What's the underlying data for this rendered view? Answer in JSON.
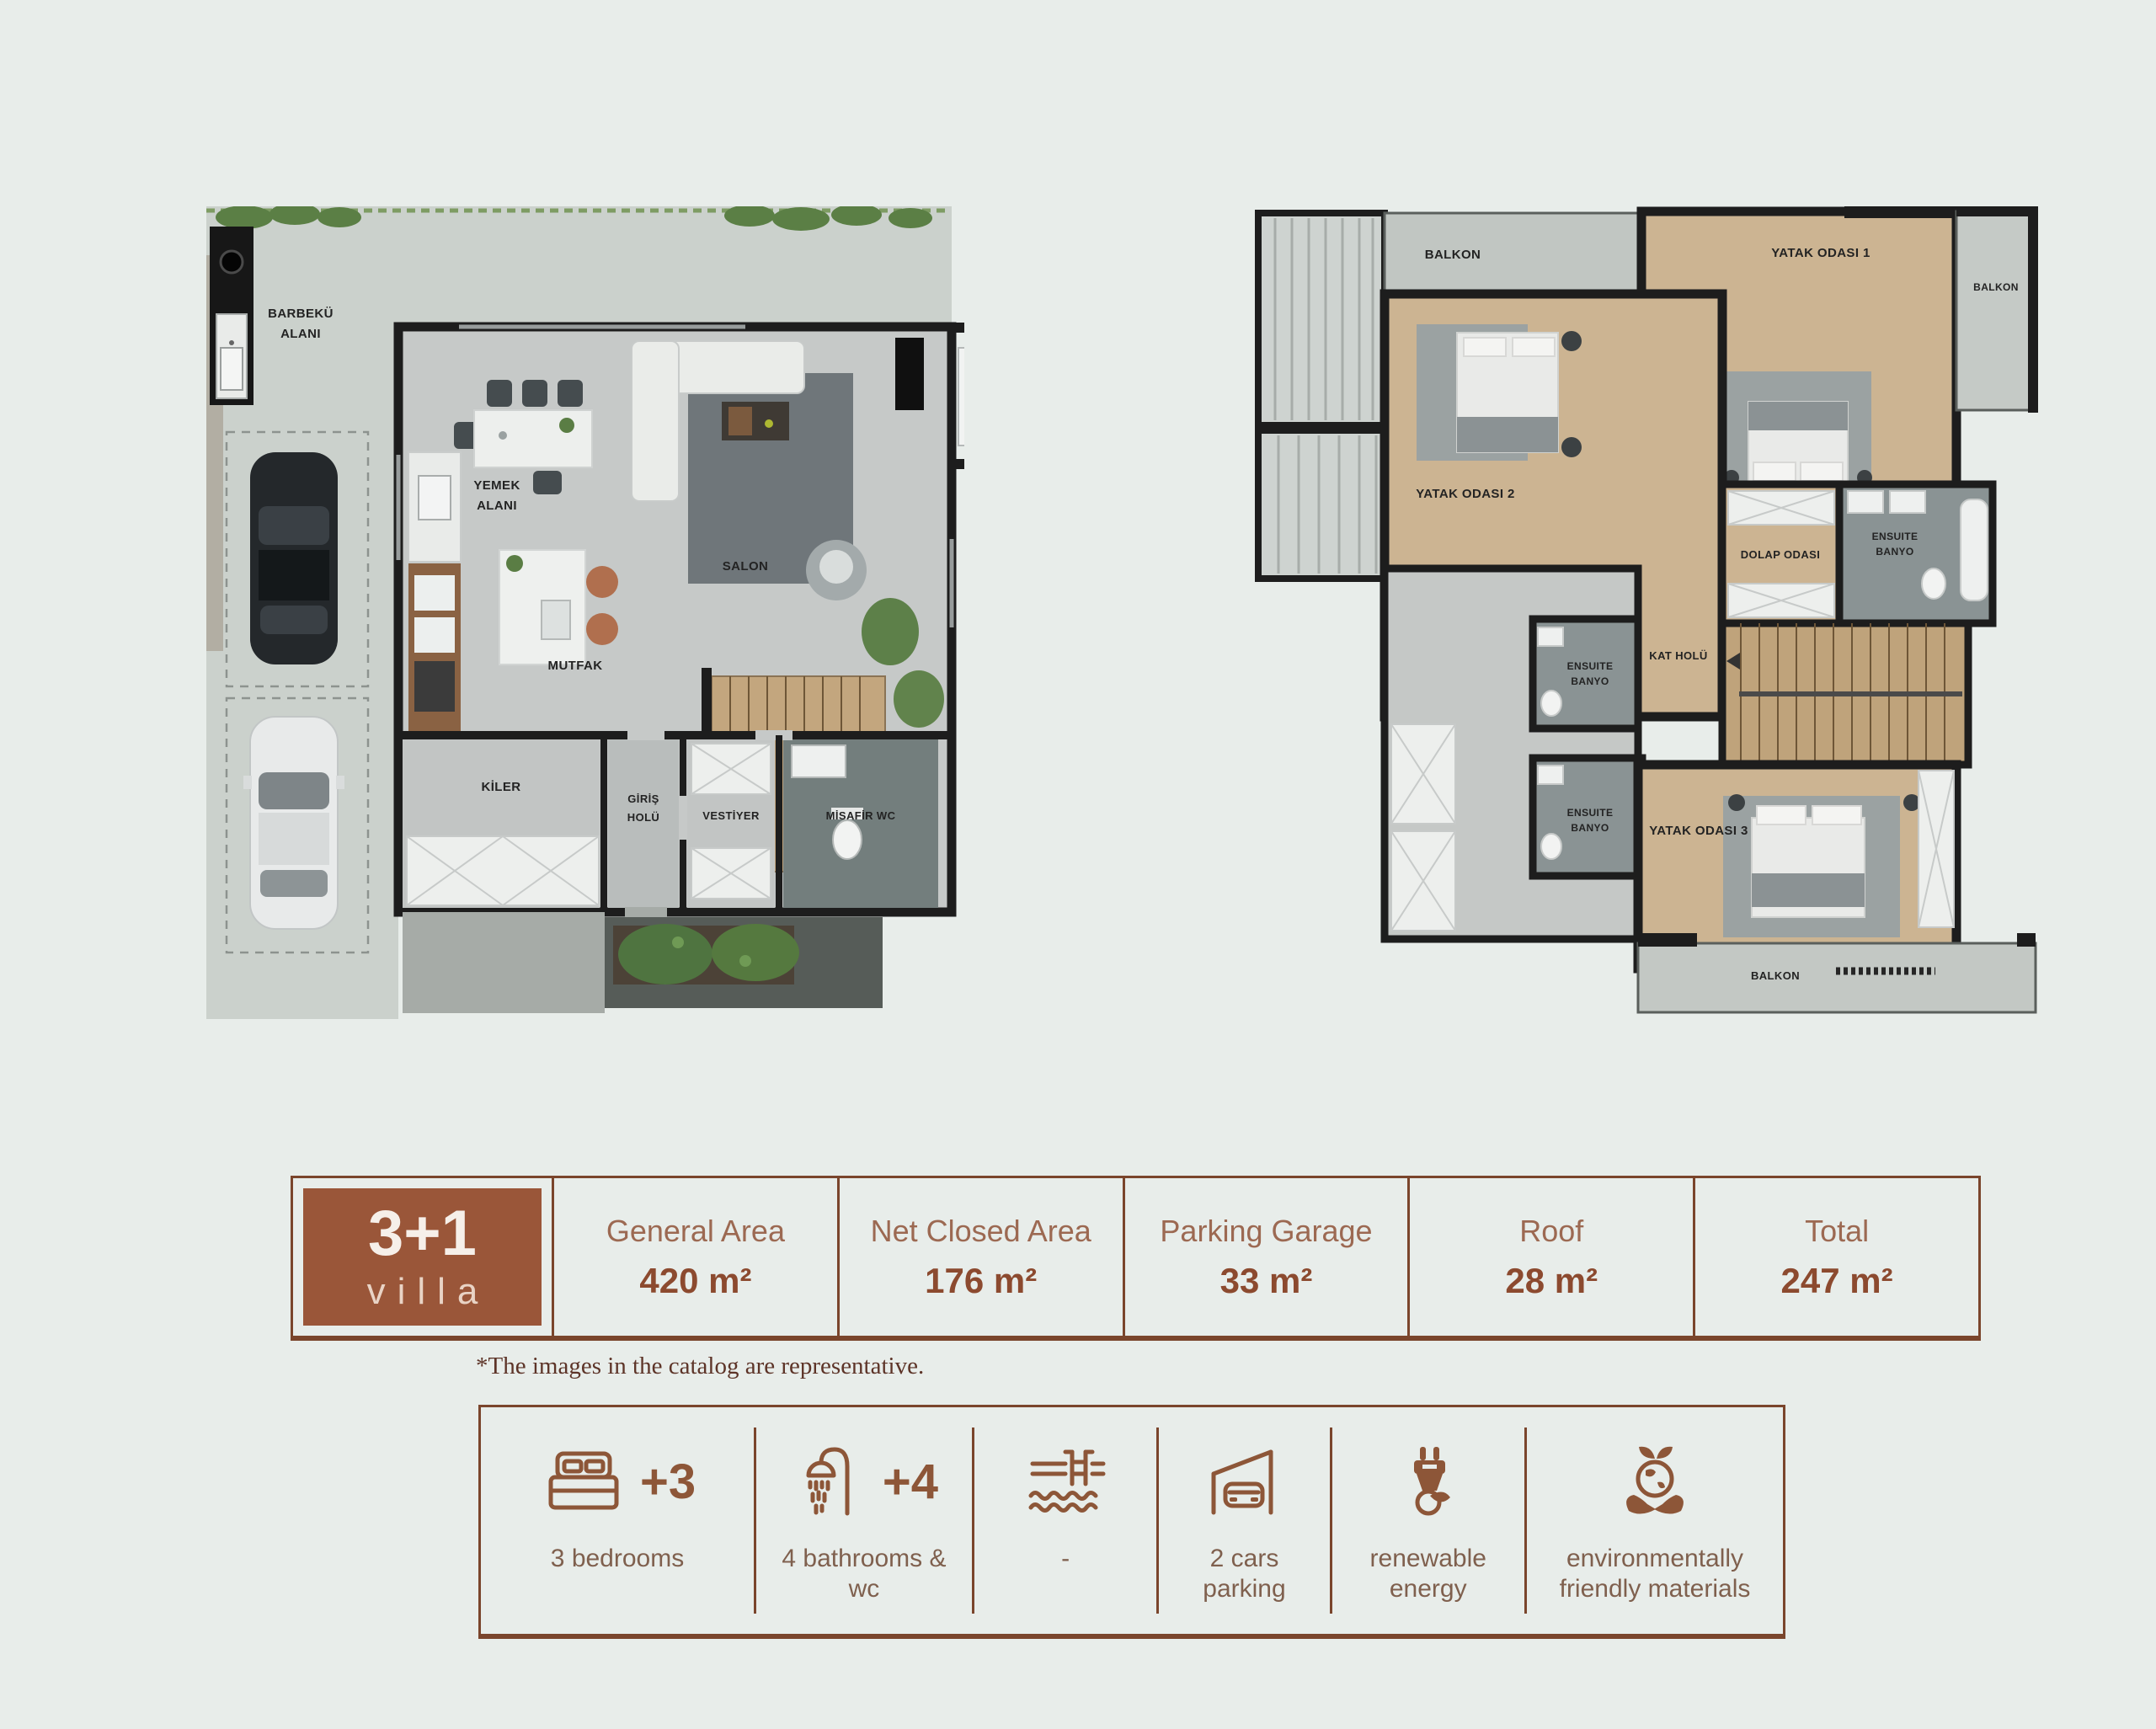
{
  "colors": {
    "background": "#e8edea",
    "accent_brown": "#8d5638",
    "badge_brown": "#9a5639",
    "wall_black": "#1d1d1d",
    "wood_floor": "#ccb492",
    "terrace_gray": "#cbd1cc"
  },
  "ground_plan": {
    "labels": {
      "barbeku_1": "BARBEKÜ",
      "barbeku_2": "ALANI",
      "yemek_1": "YEMEK",
      "yemek_2": "ALANI",
      "salon": "SALON",
      "mutfak": "MUTFAK",
      "kiler": "KİLER",
      "giris_1": "GİRİŞ",
      "giris_2": "HOLÜ",
      "vestiyer": "VESTİYER",
      "misafir_wc": "MİSAFİR WC"
    }
  },
  "upper_plan": {
    "labels": {
      "balkon_tl": "BALKON",
      "yatak_1": "YATAK ODASI 1",
      "balkon_tr": "BALKON",
      "yatak_2": "YATAK ODASI 2",
      "dolap": "DOLAP ODASI",
      "ensuite_1a": "ENSUITE",
      "ensuite_1b": "BANYO",
      "kat_holu": "KAT HOLÜ",
      "ensuite_2a": "ENSUITE",
      "ensuite_2b": "BANYO",
      "ensuite_3a": "ENSUITE",
      "ensuite_3b": "BANYO",
      "yatak_3": "YATAK ODASI 3",
      "balkon_b": "BALKON"
    }
  },
  "spec_table": {
    "badge_line1": "3+1",
    "badge_line2": "villa",
    "columns": [
      {
        "label": "General Area",
        "value": "420 m²"
      },
      {
        "label": "Net Closed Area",
        "value": "176 m²"
      },
      {
        "label": "Parking Garage",
        "value": "33 m²"
      },
      {
        "label": "Roof",
        "value": "28 m²"
      },
      {
        "label": "Total",
        "value": "247 m²"
      }
    ]
  },
  "disclaimer": "*The images in the catalog are representative.",
  "features": [
    {
      "icon": "bed-icon",
      "count": "+3",
      "label": "3 bedrooms"
    },
    {
      "icon": "shower-icon",
      "count": "+4",
      "label": "4 bathrooms & wc"
    },
    {
      "icon": "pool-icon",
      "count": "",
      "label": "-"
    },
    {
      "icon": "car-garage-icon",
      "count": "",
      "label": "2 cars parking"
    },
    {
      "icon": "plug-icon",
      "count": "",
      "label": "renewable energy"
    },
    {
      "icon": "eco-icon",
      "count": "",
      "label": "environmentally friendly materials"
    }
  ]
}
